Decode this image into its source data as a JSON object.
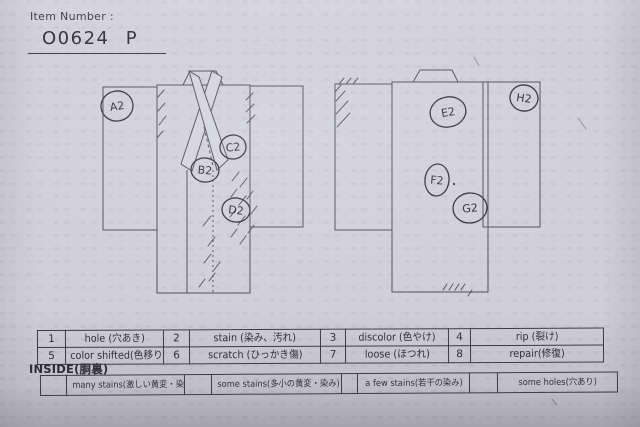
{
  "header": {
    "item_number_label": "Item Number :",
    "item_number_value": "O0624 P"
  },
  "diagrams": {
    "front_markers": [
      {
        "label": "A2"
      },
      {
        "label": "B2"
      },
      {
        "label": "C2"
      },
      {
        "label": "D2"
      }
    ],
    "back_markers": [
      {
        "label": "E2"
      },
      {
        "label": "F2"
      },
      {
        "label": "G2"
      },
      {
        "label": "H2"
      }
    ]
  },
  "condition_table": {
    "rows": [
      [
        {
          "num": "1",
          "label": "hole (穴あき)"
        },
        {
          "num": "2",
          "label": "stain (染み、汚れ)"
        },
        {
          "num": "3",
          "label": "discolor (色やけ)"
        },
        {
          "num": "4",
          "label": "rip (裂け)"
        }
      ],
      [
        {
          "num": "5",
          "label": "color shifted(色移り)"
        },
        {
          "num": "6",
          "label": "scratch (ひっかき傷)"
        },
        {
          "num": "7",
          "label": "loose (ほつれ)"
        },
        {
          "num": "8",
          "label": "repair(修復)"
        }
      ]
    ]
  },
  "inside_section": {
    "label": "INSIDE(胴裏)",
    "options": [
      {
        "label": "many stains(激しい黄変・染み)"
      },
      {
        "label": "some stains(多小の黄変・染み)"
      },
      {
        "label": "a few stains(若干の染み)"
      },
      {
        "label": "some holes(穴あり)"
      }
    ]
  },
  "colors": {
    "paper": "#d2d1db",
    "print_ink": "#4b4b58",
    "pen_annotation": "#2e2e3a"
  }
}
